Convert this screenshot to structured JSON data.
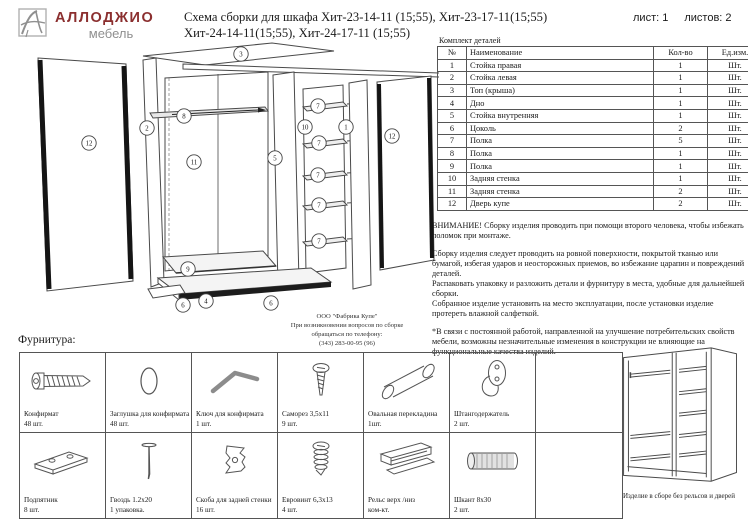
{
  "logo": {
    "brand": "АЛЛОДЖИО",
    "sub": "мебель"
  },
  "header": {
    "title_line1": "Схема сборки для шкафа Хит-23-14-11 (15;55), Хит-23-17-11(15;55)",
    "title_line2": "Хит-24-14-11(15;55), Хит-24-17-11 (15;55)",
    "sheet": "лист: 1",
    "sheets": "листов: 2"
  },
  "parts_table": {
    "caption": "Комплект деталей",
    "columns": [
      "№",
      "Наименование",
      "Кол-во",
      "Ед.изм."
    ],
    "rows": [
      [
        "1",
        "Стойка правая",
        "1",
        "Шт."
      ],
      [
        "2",
        "Стойка левая",
        "1",
        "Шт."
      ],
      [
        "3",
        "Топ (крыша)",
        "1",
        "Шт."
      ],
      [
        "4",
        "Дно",
        "1",
        "Шт."
      ],
      [
        "5",
        "Стойка внутренняя",
        "1",
        "Шт."
      ],
      [
        "6",
        "Цоколь",
        "2",
        "Шт."
      ],
      [
        "7",
        "Полка",
        "5",
        "Шт."
      ],
      [
        "8",
        "Полка",
        "1",
        "Шт."
      ],
      [
        "9",
        "Полка",
        "1",
        "Шт."
      ],
      [
        "10",
        "Задняя стенка",
        "1",
        "Шт."
      ],
      [
        "11",
        "Задняя стенка",
        "2",
        "Шт."
      ],
      [
        "12",
        "Дверь купе",
        "2",
        "Шт."
      ]
    ]
  },
  "notes": {
    "blocks": [
      [
        "ВНИМАНИЕ! Сборку изделия проводить при помощи второго человека, чтобы избежать поломок при монтаже."
      ],
      [
        "Сборку изделия следует проводить на ровной поверхности, покрытой тканью или бумагой, избегая ударов и неосторожных приемов, во избежание царапин и повреждений деталей.",
        "Распаковать упаковку и разложить детали и фурнитуру в места, удобные для дальнейшей сборки.",
        "Собранное изделие установить на место эксплуатации, после установки изделие протереть влажной салфеткой."
      ],
      [
        "*В связи с постоянной работой, направленной на улучшение потребительских свойств мебели, возможны незначительные изменения в конструкции не влияющие на функциональные качества изделий."
      ]
    ]
  },
  "diagram": {
    "contact_lines": [
      "ООО \"Фабрика Купе\"",
      "При возникновении вопросов по сборке",
      "обращаться по телефону:",
      "(343) 283-00-95 (96)"
    ],
    "callouts": [
      {
        "n": "3",
        "x": 219,
        "y": 12
      },
      {
        "n": "8",
        "x": 162,
        "y": 74
      },
      {
        "n": "2",
        "x": 125,
        "y": 86
      },
      {
        "n": "12",
        "x": 67,
        "y": 101
      },
      {
        "n": "11",
        "x": 172,
        "y": 120
      },
      {
        "n": "5",
        "x": 253,
        "y": 116
      },
      {
        "n": "10",
        "x": 283,
        "y": 85
      },
      {
        "n": "7",
        "x": 296,
        "y": 64
      },
      {
        "n": "7",
        "x": 297,
        "y": 101
      },
      {
        "n": "7",
        "x": 296,
        "y": 133
      },
      {
        "n": "7",
        "x": 297,
        "y": 163
      },
      {
        "n": "7",
        "x": 297,
        "y": 199
      },
      {
        "n": "1",
        "x": 324,
        "y": 85
      },
      {
        "n": "12",
        "x": 370,
        "y": 94
      },
      {
        "n": "9",
        "x": 166,
        "y": 227
      },
      {
        "n": "4",
        "x": 184,
        "y": 259
      },
      {
        "n": "6",
        "x": 161,
        "y": 263
      },
      {
        "n": "6",
        "x": 249,
        "y": 261
      }
    ]
  },
  "hardware": {
    "label": "Фурнитура:",
    "items": [
      {
        "name": "Конфирмат",
        "qty": "48 шт."
      },
      {
        "name": "Заглушка для конфирмата",
        "qty": "48 шт."
      },
      {
        "name": "Ключ для конфирмата",
        "qty": "1 шт."
      },
      {
        "name": "Саморез 3,5х11",
        "qty": "9 шт."
      },
      {
        "name": "Овальная перекладина",
        "qty": "1шт."
      },
      {
        "name": "Штангодержатель",
        "qty": "2 шт."
      },
      {
        "name": "Подпятник",
        "qty": "8 шт."
      },
      {
        "name": "Гвоздь 1.2х20",
        "qty": "1 упаковка."
      },
      {
        "name": "Скоба для задней стенки",
        "qty": "16 шт."
      },
      {
        "name": "Евровинт 6,3х13",
        "qty": "4 шт."
      },
      {
        "name": "Рельс верх /низ",
        "qty": "ком-кт."
      },
      {
        "name": "Шкант 8х30",
        "qty": "2 шт."
      }
    ]
  },
  "assembled": {
    "caption": "Изделие в сборе без рельсов и дверей"
  }
}
